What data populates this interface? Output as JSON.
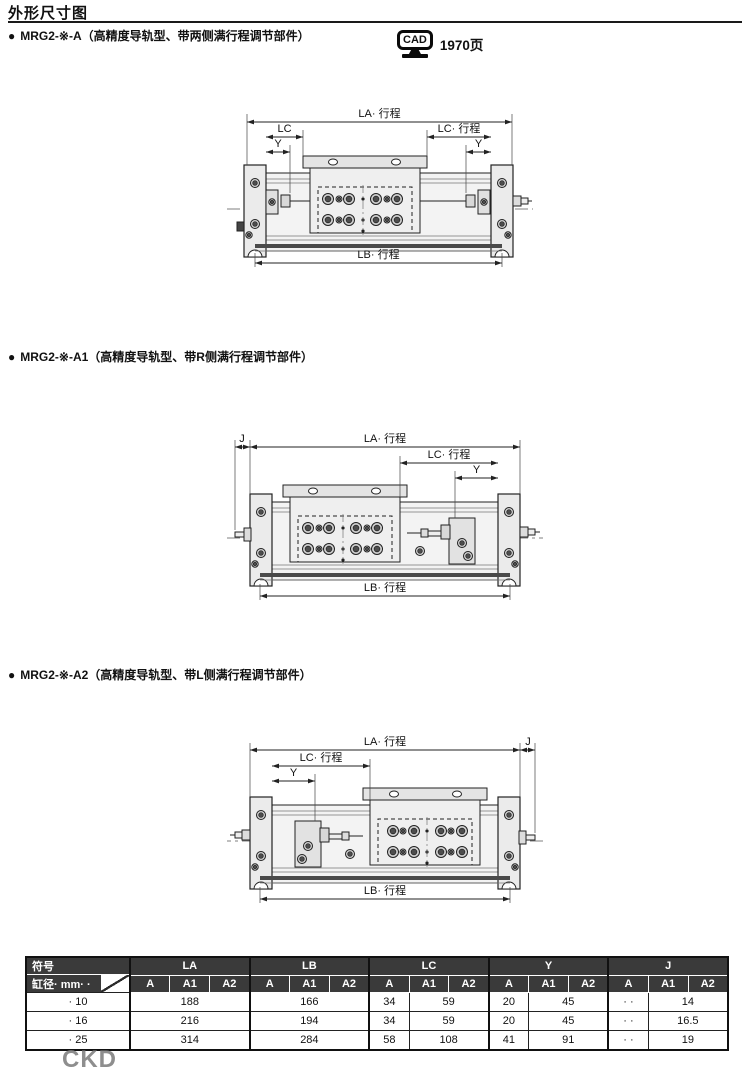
{
  "page": {
    "title": "外形尺寸图",
    "bullet": "●",
    "cad": {
      "label": "CAD",
      "page": "1970页"
    },
    "logo": "CKD"
  },
  "sections": [
    {
      "title": "MRG2-※-A（高精度导轨型、带两侧满行程调节部件）",
      "dims": {
        "la": "LA· 行程",
        "lc_left": "LC",
        "lc_right": "LC· 行程",
        "y_left": "Y",
        "y_right": "Y",
        "lb": "LB· 行程"
      }
    },
    {
      "title": "MRG2-※-A1（高精度导轨型、带R侧满行程调节部件）",
      "dims": {
        "j": "J",
        "la": "LA· 行程",
        "lc": "LC· 行程",
        "y": "Y",
        "lb": "LB· 行程"
      }
    },
    {
      "title": "MRG2-※-A2（高精度导轨型、带L侧满行程调节部件）",
      "dims": {
        "j": "J",
        "la": "LA· 行程",
        "lc": "LC· 行程",
        "y": "Y",
        "lb": "LB· 行程"
      }
    }
  ],
  "table": {
    "corner_top": "符号",
    "corner_bottom": "缸径· mm· ·",
    "groups": [
      "LA",
      "LB",
      "LC",
      "Y",
      "J"
    ],
    "sub": [
      "A",
      "A1",
      "A2"
    ],
    "rows": [
      {
        "bore": "· 10",
        "la": "188",
        "lb": "166",
        "lc_a": "34",
        "lc_a12": "59",
        "y_a": "20",
        "y_a12": "45",
        "j_a": "· ·",
        "j_a12": "14"
      },
      {
        "bore": "· 16",
        "la": "216",
        "lb": "194",
        "lc_a": "34",
        "lc_a12": "59",
        "y_a": "20",
        "y_a12": "45",
        "j_a": "· ·",
        "j_a12": "16.5"
      },
      {
        "bore": "· 25",
        "la": "314",
        "lb": "284",
        "lc_a": "58",
        "lc_a12": "108",
        "y_a": "41",
        "y_a12": "91",
        "j_a": "· ·",
        "j_a12": "19"
      }
    ]
  }
}
